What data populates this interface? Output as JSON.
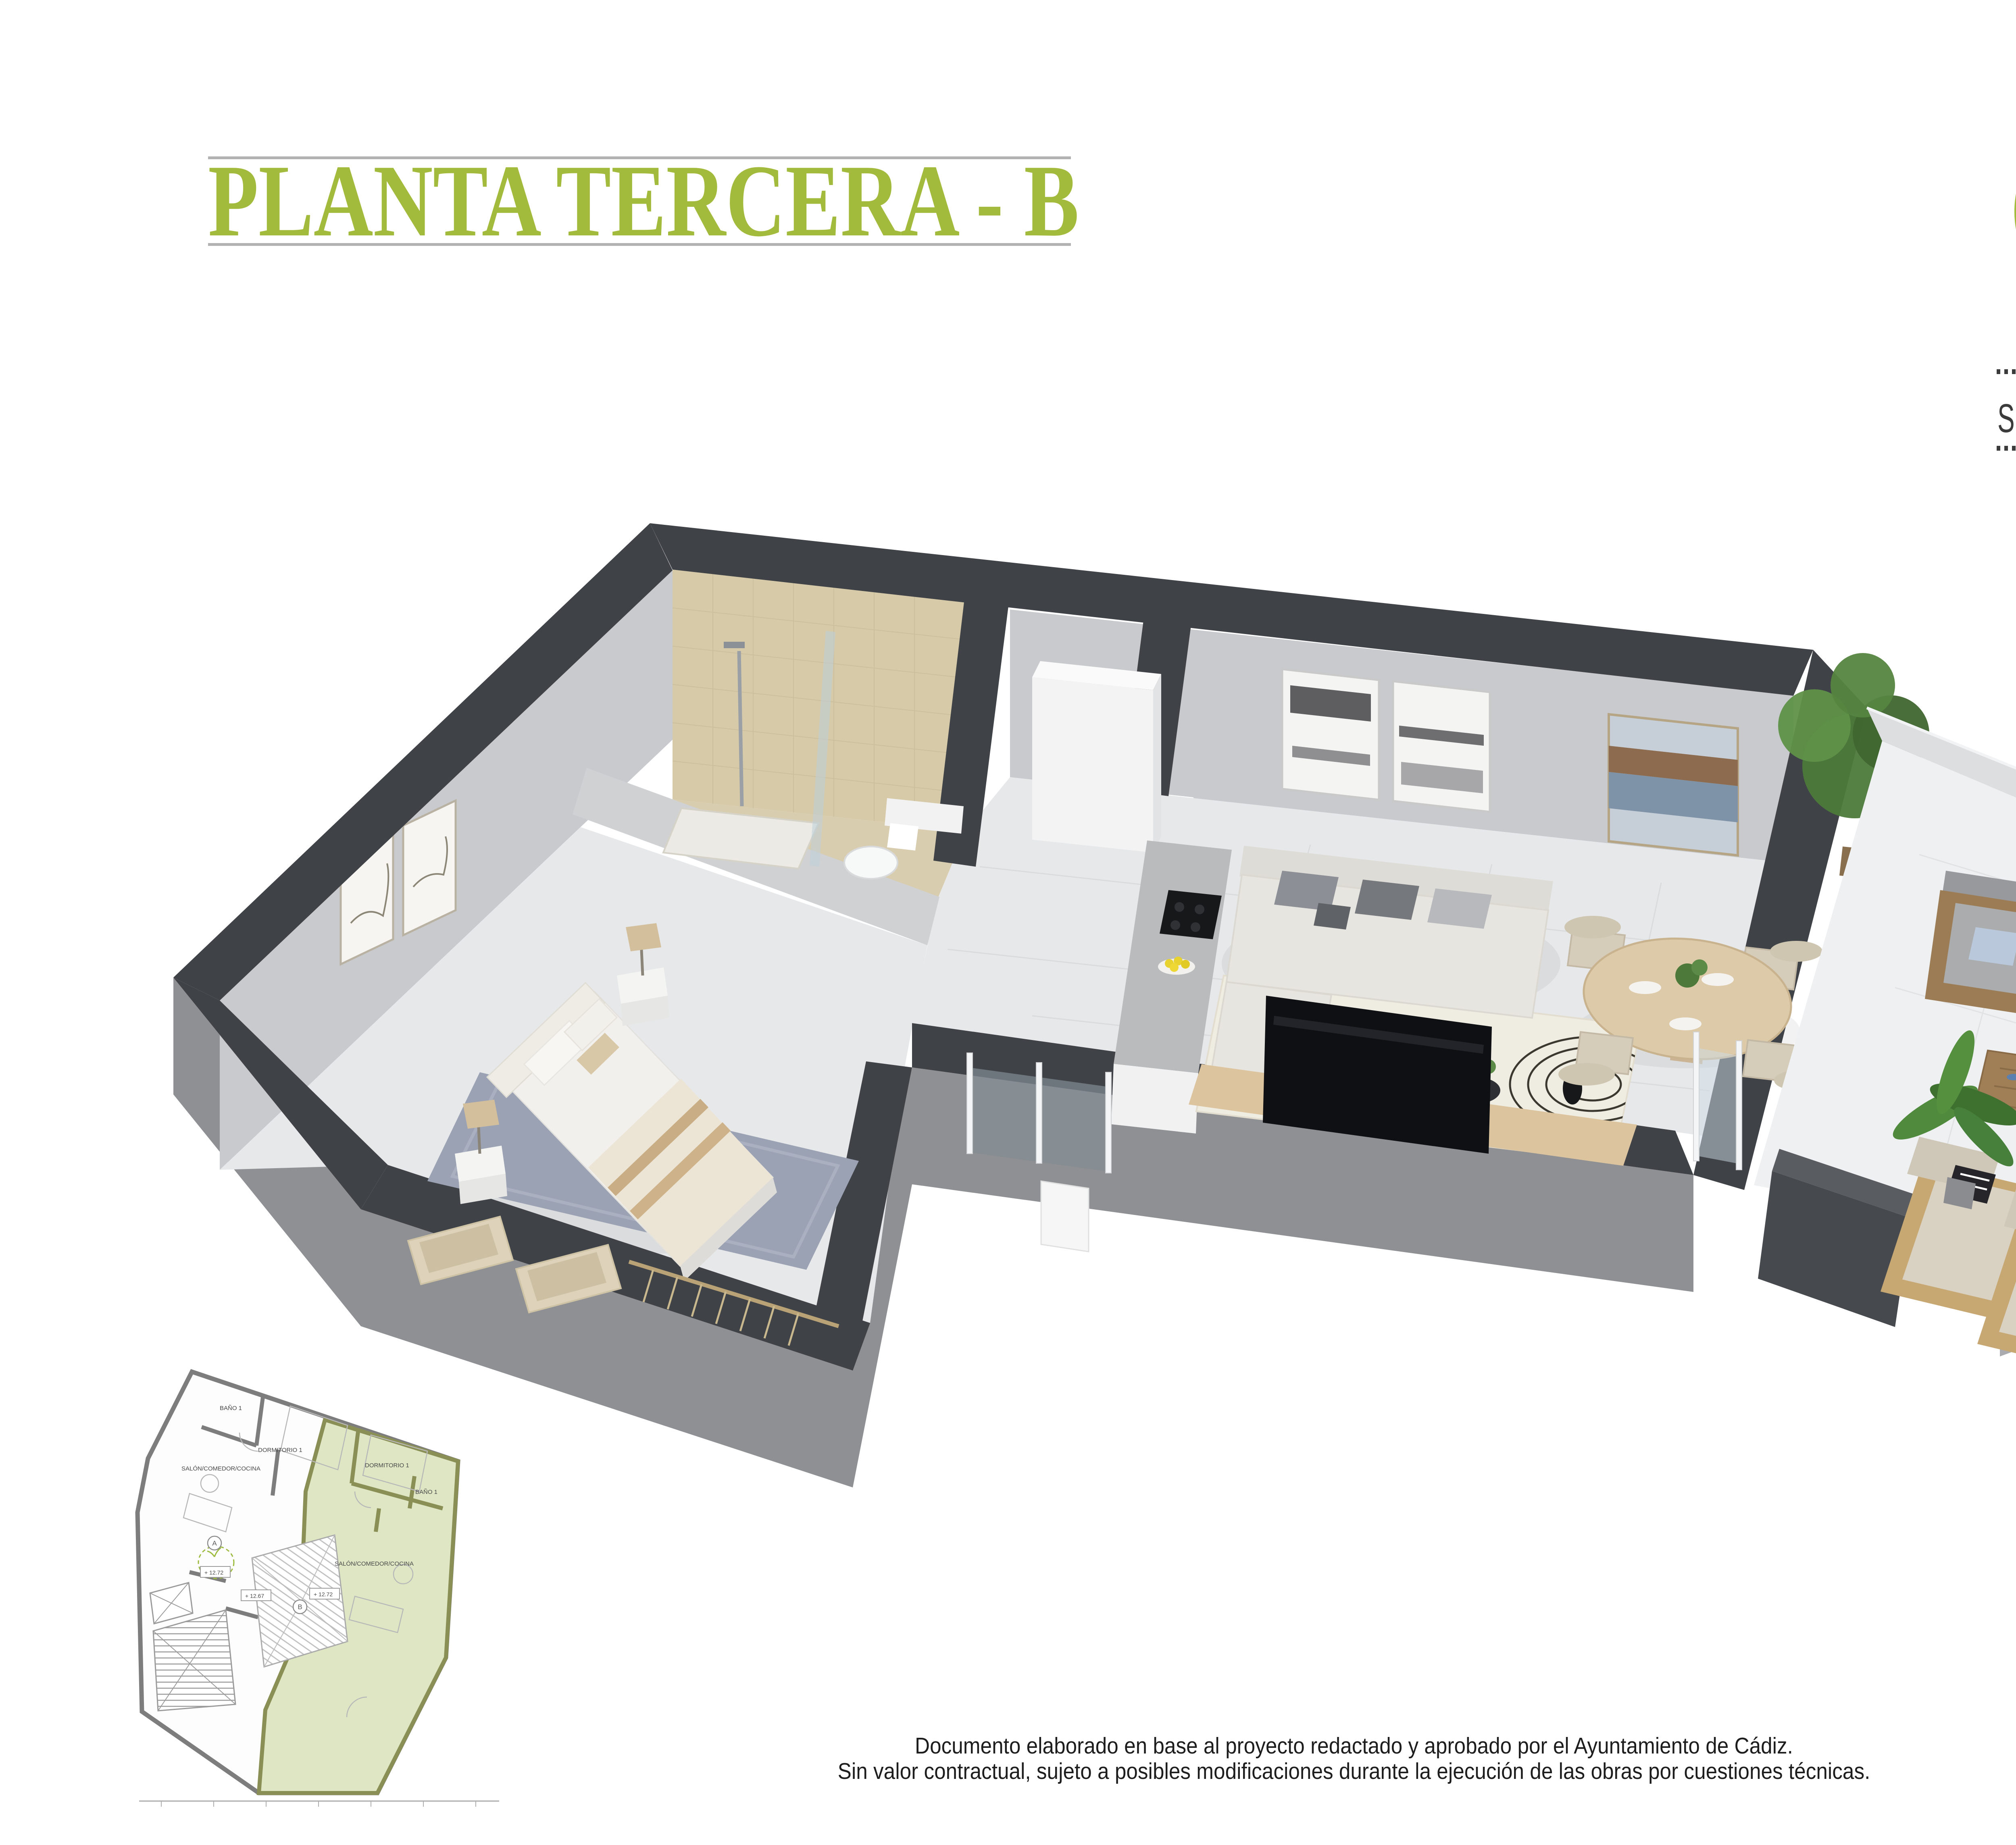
{
  "header": {
    "title": "PLANTA TERCERA - B"
  },
  "logo": {
    "brand_line1": "CRISTOBAL",
    "brand_line2": "COLÓN",
    "brand_number": "24"
  },
  "area_banner": {
    "label": "SUPERFICIE CONSTRUIDA CON ZZCC:",
    "value": "70,14",
    "unit": "M",
    "unit_sup": "2"
  },
  "footer": {
    "line1": "Documento elaborado en base al proyecto redactado y aprobado por el Ayuntamiento de Cádiz.",
    "line2": "Sin valor contractual, sujeto a posibles modificaciones durante la ejecución de las obras por cuestiones técnicas."
  },
  "key_plan": {
    "unit_a": {
      "bath": "BAÑO 1",
      "bedroom": "DORMITORIO 1",
      "living": "SALÓN/COMEDOR/COCINA",
      "level": "+ 12.72",
      "tag": "A"
    },
    "unit_b": {
      "bath": "BAÑO 1",
      "bedroom": "DORMITORIO 1",
      "living": "SALÓN/COMEDOR/COCINA",
      "level": "+ 12.72",
      "tag": "B"
    },
    "courtyard_level": "+ 12.67"
  },
  "colors": {
    "accent_green": "#a3bb3d",
    "logo_green": "#a0bc3a",
    "logo_text": "#322a24",
    "rule_gray": "#b2b2b2",
    "banner_text": "#3b3b3b",
    "disclaimer_text": "#1d1d1d",
    "wall_dark": "#3f4247",
    "facade_gray": "#8e9093",
    "wall_face": "#c9cacd",
    "bath_tile_wall": "#d6caa9",
    "bath_tile_floor": "#d9cdb0",
    "floor_light": "#e7e8ea",
    "terrace_floor": "#eef0f2",
    "plant_green": "#4d7a3b",
    "keyplan_wall": "#7d7d7d",
    "unit_b_fill": "#dfe6c4",
    "unit_b_wall": "#8a8f55"
  }
}
